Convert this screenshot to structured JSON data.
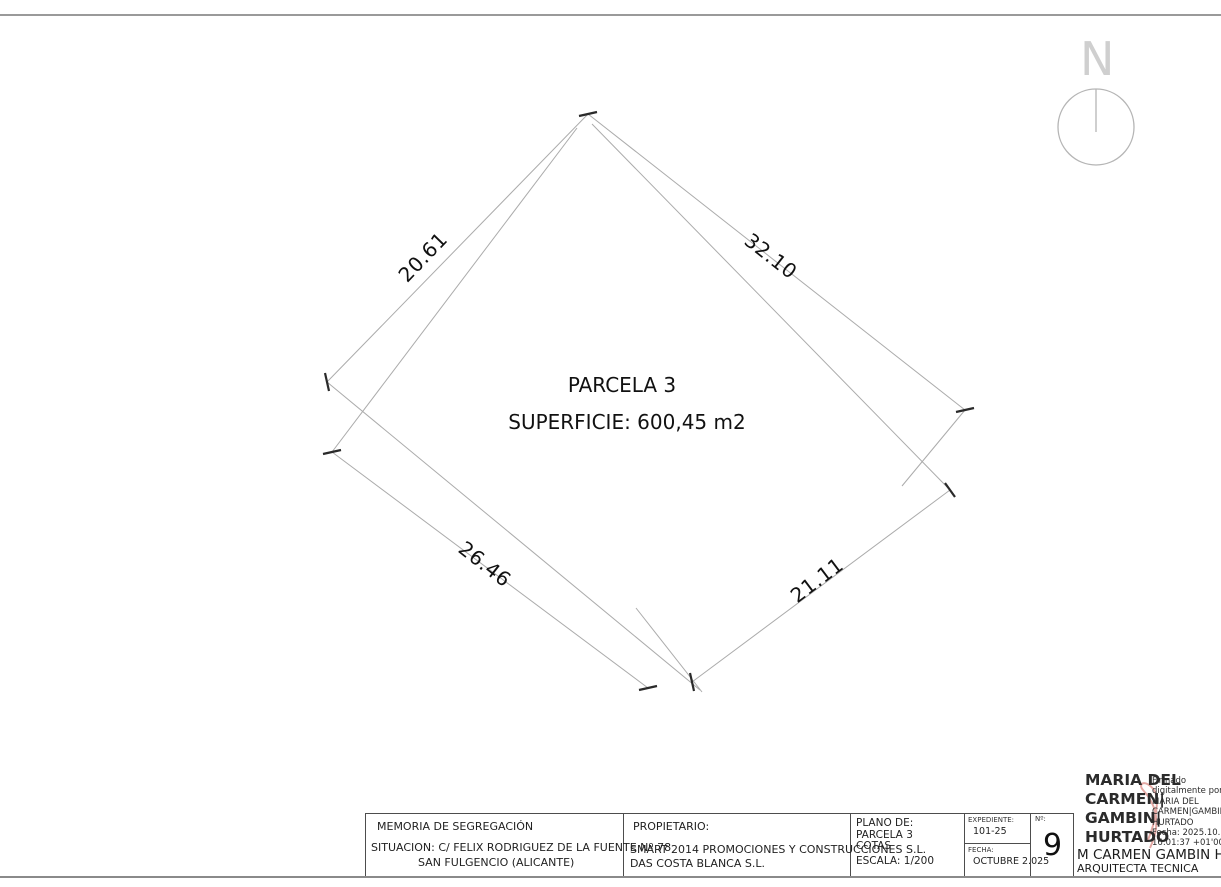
{
  "drawing": {
    "parcel_label": "PARCELA 3",
    "surface_label": "SUPERFICIE: 600,45 m2",
    "north_label": "N",
    "dimensions": [
      {
        "side": "top-left",
        "value": "20.61"
      },
      {
        "side": "top-right",
        "value": "32.10"
      },
      {
        "side": "bottom-left",
        "value": "26.46"
      },
      {
        "side": "bottom-right",
        "value": "21.11"
      }
    ]
  },
  "title_block": {
    "project": {
      "title": "MEMORIA DE SEGREGACIÓN",
      "situation_line1": "SITUACION: C/ FELIX RODRIGUEZ DE LA FUENTE Nº 78",
      "situation_line2": "SAN FULGENCIO (ALICANTE)"
    },
    "owner": {
      "label": "PROPIETARIO:",
      "line1": "SMART 2014 PROMOCIONES Y CONSTRUCCIONES S.L.",
      "line2": "DAS COSTA BLANCA S.L."
    },
    "plan": {
      "label": "PLANO DE:",
      "line1": "PARCELA 3",
      "line2": "COTAS",
      "scale": "ESCALA: 1/200"
    },
    "file": {
      "expediente_label": "EXPEDIENTE:",
      "expediente": "101-25",
      "fecha_label": "FECHA:",
      "fecha": "OCTUBRE 2.025"
    },
    "sheet": {
      "number_label": "Nº:",
      "number": "9"
    },
    "signature": {
      "name_big": [
        "MARIA DEL",
        "CARMEN|",
        "GAMBIN|",
        "HURTADO"
      ],
      "details": [
        "Firmado",
        "digitalmente por",
        "MARIA DEL",
        "CARMEN|GAMBIN|",
        "HURTADO",
        "Fecha: 2025.10.30",
        "16:01:37 +01'00'"
      ],
      "name_printed": "M CARMEN GAMBIN HURTADO",
      "title_printed": "ARQUITECTA TECNICA"
    }
  }
}
